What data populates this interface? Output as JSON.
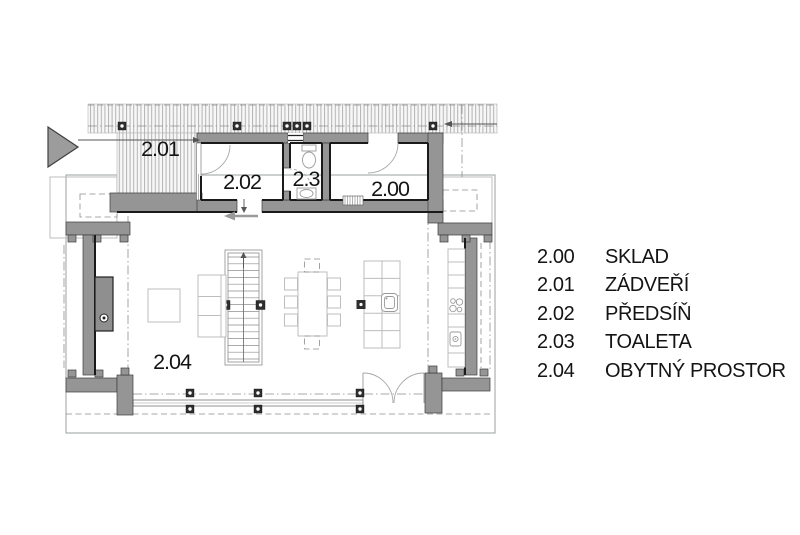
{
  "legend": {
    "items": [
      {
        "number": "2.00",
        "name": "SKLAD"
      },
      {
        "number": "2.01",
        "name": "ZÁDVEŘÍ"
      },
      {
        "number": "2.02",
        "name": "PŘEDSÍŇ"
      },
      {
        "number": "2.03",
        "name": "TOALETA"
      },
      {
        "number": "2.04",
        "name": "OBYTNÝ PROSTOR"
      }
    ]
  },
  "plan": {
    "rooms": [
      {
        "label": "2.01"
      },
      {
        "label": "2.02"
      },
      {
        "label": "2.3"
      },
      {
        "label": "2.00"
      },
      {
        "label": "2.04"
      }
    ]
  },
  "colors": {
    "wall_fill": "#959595",
    "outline": "#1a1a1a",
    "furniture_line": "#bdbdbd",
    "hatch_line": "#b3b3b3",
    "arrow_fill": "#9c9c9c"
  }
}
